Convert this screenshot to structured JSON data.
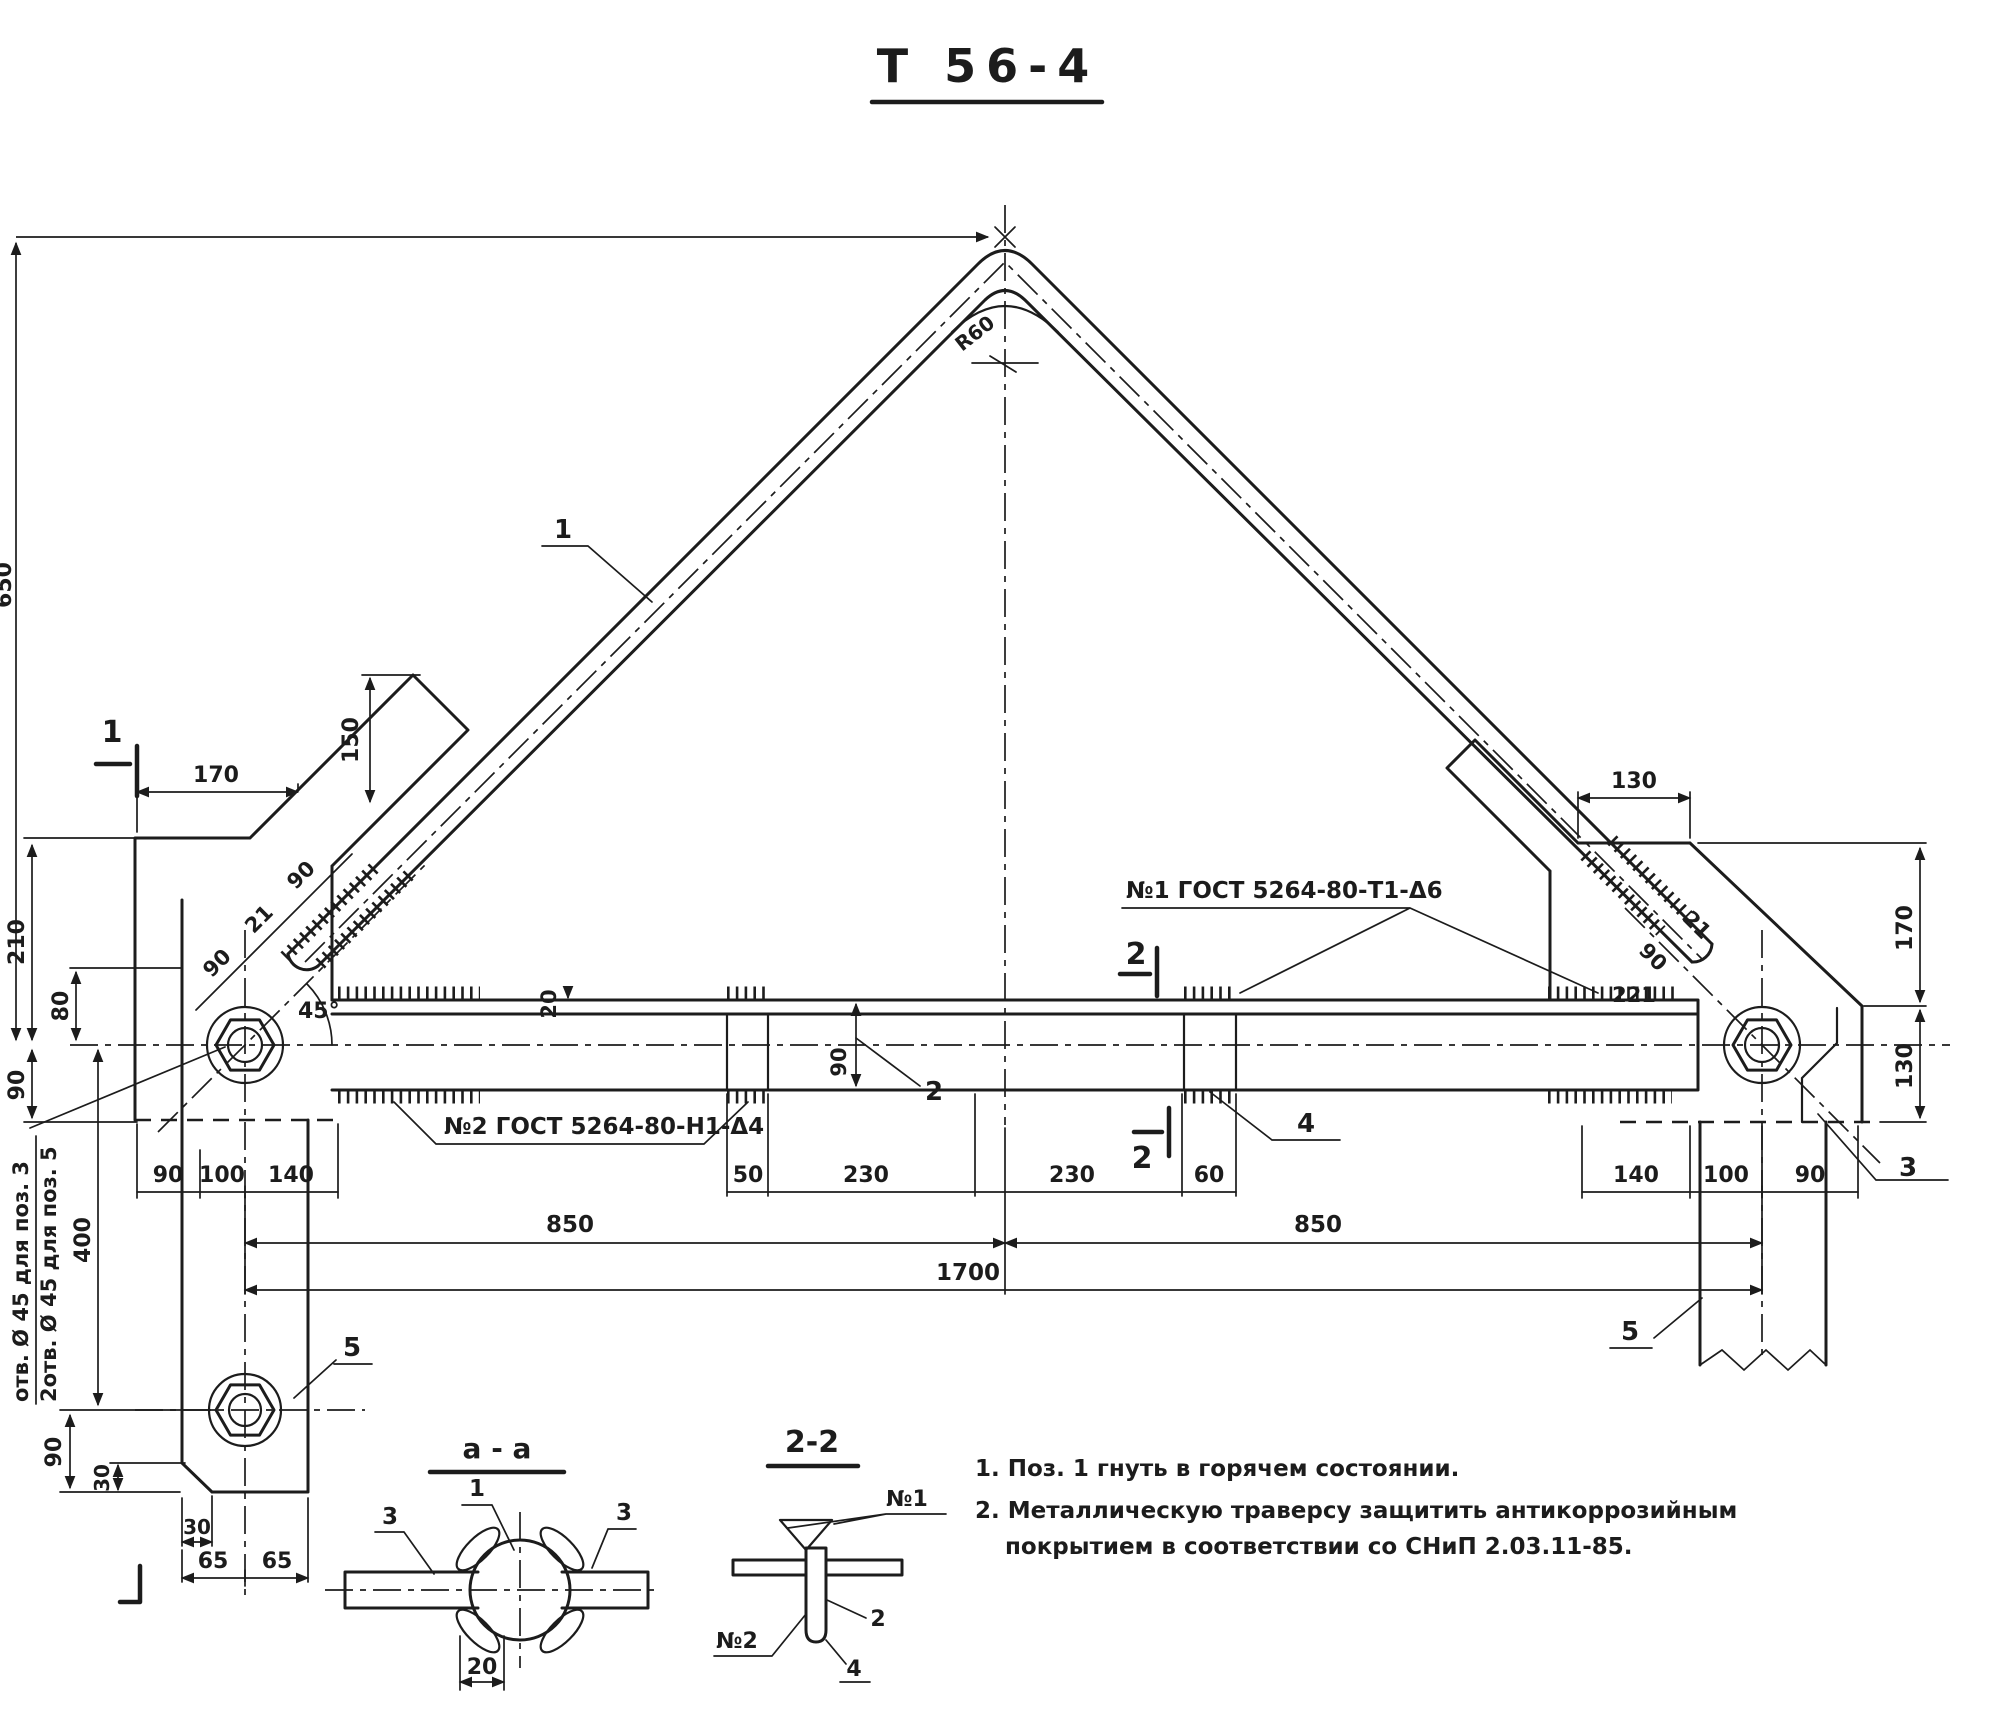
{
  "colors": {
    "ink": "#1c1c1c",
    "paper": "#ffffff"
  },
  "title": "Т 56-4",
  "weld_labels": {
    "n1": "№1 ГОСТ 5264-80-Т1-Δ6",
    "n2": "№2 ГОСТ 5264-80-Н1-Δ4"
  },
  "notes": [
    "1. Поз. 1 гнуть в горячем состоянии.",
    "2. Металлическую траверсу защитить антикоррозийным",
    "покрытием в соответствии со СНиП 2.03.11-85."
  ],
  "hole_note": [
    "отв. Ø 45 для поз. 3",
    "2отв. Ø 45 для поз. 5"
  ],
  "sections": {
    "aa_title": "а - а",
    "s22_title": "2-2"
  },
  "markers": {
    "sec1": "1",
    "sec2_top": "2",
    "sec2_bottom": "2"
  },
  "callouts": {
    "pos1": "1",
    "pos2": "2",
    "pos3": "3",
    "pos4": "4",
    "pos5_left": "5",
    "pos5_right": "5",
    "aa_pos1": "1",
    "aa_pos3_left": "3",
    "aa_pos3_right": "3",
    "s22_n1": "№1",
    "s22_n2": "№2",
    "s22_pos2": "2",
    "s22_pos4": "4"
  },
  "dims": {
    "v650": "650",
    "h170": "170",
    "v150": "150",
    "v210": "210",
    "v80": "80",
    "v90_left": "90",
    "rod_90a": "90",
    "rod_21": "21",
    "rod_90b": "90",
    "angle45": "45°",
    "bend_radius": "R60",
    "bar_t20": "20",
    "plate_h90": "90",
    "row_left": [
      "90",
      "100",
      "140"
    ],
    "row_mid": [
      "50",
      "230",
      "230",
      "60"
    ],
    "row_right": [
      "140",
      "100",
      "90"
    ],
    "span_850l": "850",
    "span_850r": "850",
    "span_total": "1700",
    "v400": "400",
    "leg_90": "90",
    "leg_30v": "30",
    "leg_30h": "30",
    "leg_65a": "65",
    "leg_65b": "65",
    "r130_top": "130",
    "r170": "170",
    "r130_bot": "130",
    "r221": "221",
    "r21": "21",
    "r90": "90",
    "aa_20": "20"
  }
}
